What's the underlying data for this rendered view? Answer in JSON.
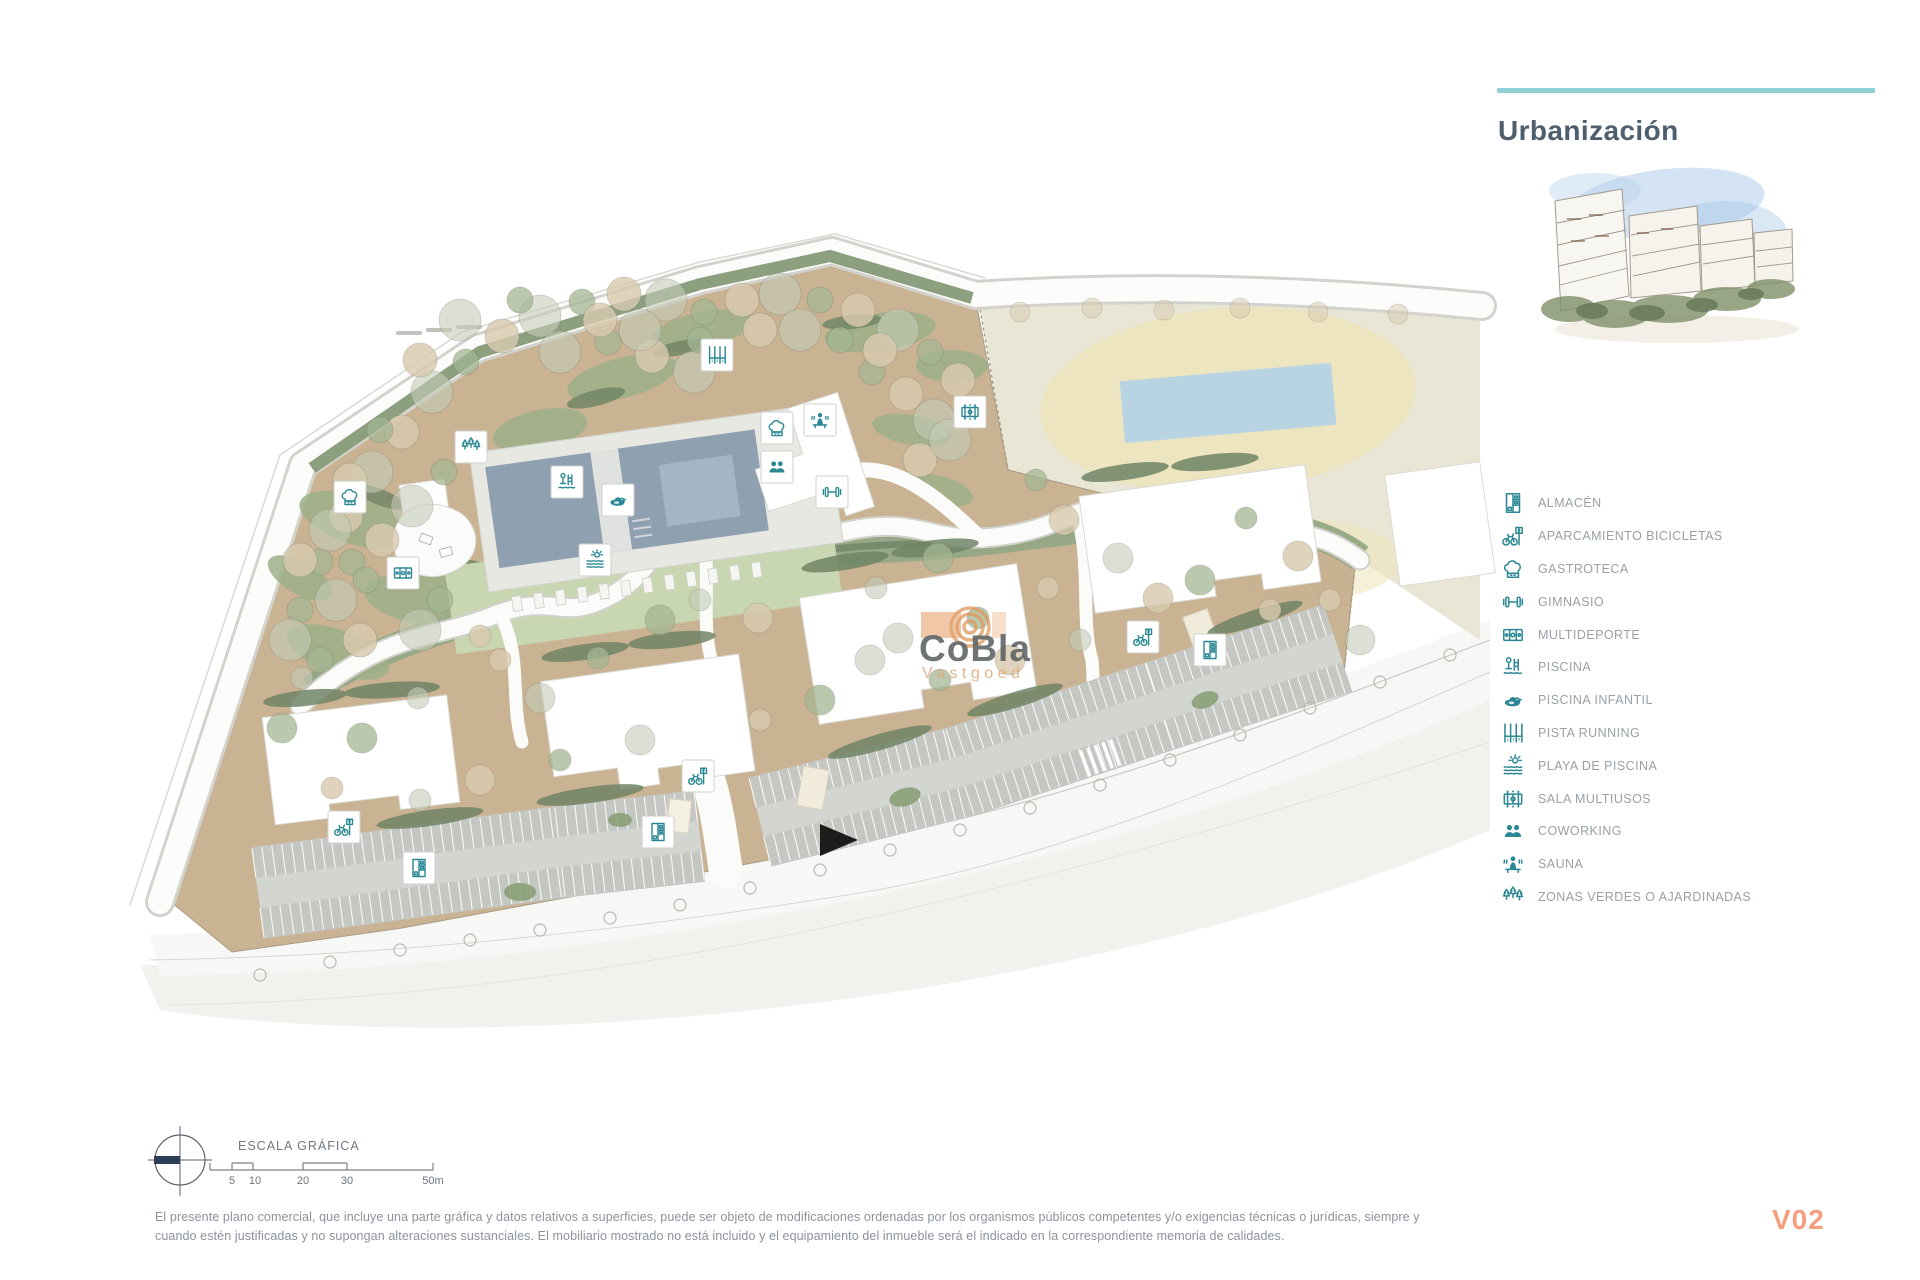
{
  "panel": {
    "title": "Urbanización",
    "legend": [
      {
        "icon": "almacen-icon",
        "label": "ALMACÉN"
      },
      {
        "icon": "bike-parking-icon",
        "label": "APARCAMIENTO BICICLETAS"
      },
      {
        "icon": "gastroteca-icon",
        "label": "GASTROTECA"
      },
      {
        "icon": "gimnasio-icon",
        "label": "GIMNASIO"
      },
      {
        "icon": "multideporte-icon",
        "label": "MULTIDEPORTE"
      },
      {
        "icon": "piscina-icon",
        "label": "PISCINA"
      },
      {
        "icon": "piscina-infantil-icon",
        "label": "PISCINA INFANTIL"
      },
      {
        "icon": "pista-running-icon",
        "label": "PISTA RUNNING"
      },
      {
        "icon": "playa-piscina-icon",
        "label": "PLAYA DE PISCINA"
      },
      {
        "icon": "sala-multiusos-icon",
        "label": "SALA MULTIUSOS"
      },
      {
        "icon": "coworking-icon",
        "label": "COWORKING"
      },
      {
        "icon": "sauna-icon",
        "label": "SAUNA"
      },
      {
        "icon": "zonas-verdes-icon",
        "label": "ZONAS VERDES O AJARDINADAS"
      }
    ]
  },
  "map": {
    "watermark": {
      "line1": "CoBla",
      "line2": "Vastgoed"
    },
    "markers": [
      {
        "icon": "zonas-verdes-icon",
        "x": 471,
        "y": 447
      },
      {
        "icon": "gastroteca-icon",
        "x": 350,
        "y": 497
      },
      {
        "icon": "multideporte-icon",
        "x": 403,
        "y": 573
      },
      {
        "icon": "piscina-icon",
        "x": 567,
        "y": 482
      },
      {
        "icon": "piscina-infantil-icon",
        "x": 618,
        "y": 500
      },
      {
        "icon": "playa-piscina-icon",
        "x": 595,
        "y": 560
      },
      {
        "icon": "pista-running-icon",
        "x": 717,
        "y": 355
      },
      {
        "icon": "gastroteca-icon",
        "x": 777,
        "y": 428
      },
      {
        "icon": "sauna-icon",
        "x": 820,
        "y": 420
      },
      {
        "icon": "coworking-icon",
        "x": 777,
        "y": 467
      },
      {
        "icon": "gimnasio-icon",
        "x": 832,
        "y": 492
      },
      {
        "icon": "sala-multiusos-icon",
        "x": 970,
        "y": 412
      },
      {
        "icon": "bike-parking-icon",
        "x": 344,
        "y": 827
      },
      {
        "icon": "bike-parking-icon",
        "x": 698,
        "y": 776
      },
      {
        "icon": "bike-parking-icon",
        "x": 1143,
        "y": 637
      },
      {
        "icon": "almacen-icon",
        "x": 419,
        "y": 868
      },
      {
        "icon": "almacen-icon",
        "x": 658,
        "y": 832
      },
      {
        "icon": "almacen-icon",
        "x": 1210,
        "y": 650
      }
    ]
  },
  "scale": {
    "title": "ESCALA GRÁFICA",
    "ticks": [
      "5",
      "10",
      "20",
      "30",
      "50m"
    ]
  },
  "footer": {
    "line1": "El presente plano comercial, que incluye una parte gráfica y datos relativos a superficies, puede ser objeto de modificaciones ordenadas por los organismos públicos competentes y/o exigencias técnicas o jurídicas, siempre y",
    "line2": "cuando estén justificadas y no supongan alteraciones sustanciales. El mobiliario mostrado no está incluido y el equipamiento del inmueble será el indicado en la correspondiente memoria de calidades.",
    "version": "V02"
  },
  "colors": {
    "accent_teal": "#2b8894",
    "teal_rule": "#8ed0d3",
    "version_color": "#f59e7e",
    "terrain_tan": "#c8b190",
    "parcel_beige": "#e9e6d6",
    "pool_blue": "#8fa0b0",
    "green_sage": "#93a884"
  }
}
